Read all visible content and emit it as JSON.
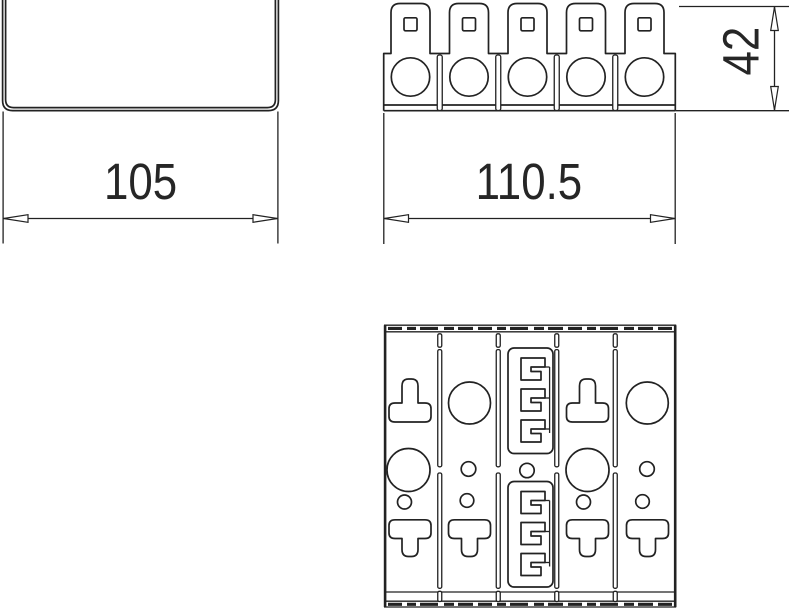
{
  "drawing": {
    "background": "#ffffff",
    "line_color": "#222222",
    "text_color": "#262626",
    "dimensions": {
      "channel_width": "105",
      "block_width": "110.5",
      "block_height": "42"
    }
  }
}
